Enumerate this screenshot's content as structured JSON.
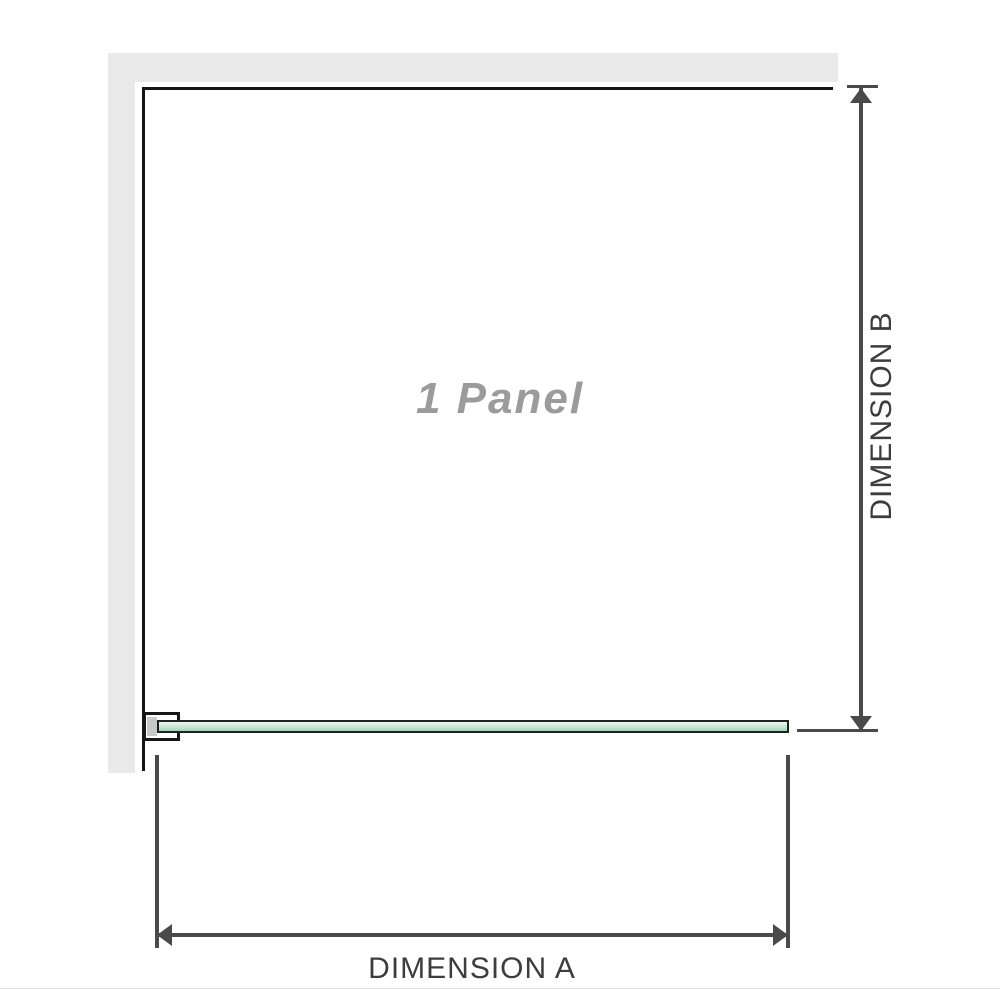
{
  "diagram": {
    "panel_label": "1 Panel",
    "dimension_a_label": "DIMENSION A",
    "dimension_b_label": "DIMENSION B"
  },
  "colors": {
    "wall": "#e9e9e9",
    "panel_border": "#151515",
    "dimension": "#4a4a4a",
    "label_text": "#3d3d3d",
    "panel_text": "#9b9b9b",
    "glass_border": "#1d241f",
    "glass_top": "#eef7f1",
    "glass_mid": "#cfe9da",
    "glass_bottom": "#a6d3b8",
    "bracket_fill": "#c9c9c9",
    "page_edge": "#dedede"
  }
}
